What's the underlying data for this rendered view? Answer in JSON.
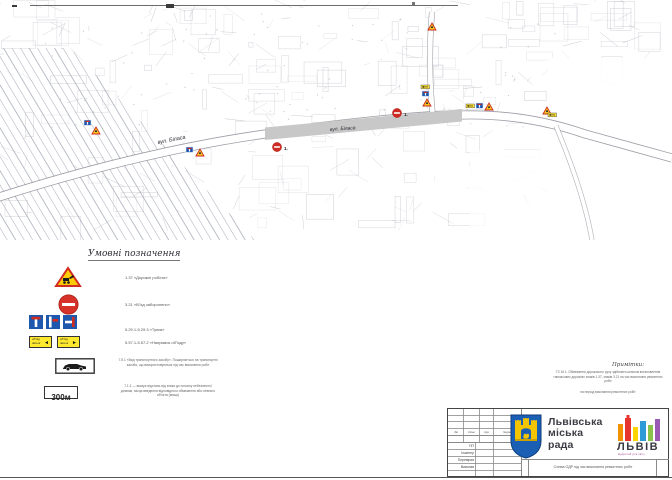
{
  "map": {
    "street_label_1": "вул. Біласа",
    "street_label_2": "вул. Біласа",
    "no_entry_label_1": "1.",
    "no_entry_label_2": "1."
  },
  "legend": {
    "title": "Умовні позначення",
    "rows": [
      {
        "code_text": "1.37 «Дорожні роботи»"
      },
      {
        "code_text": "3.21 «В'їзд заборонено»"
      },
      {
        "code_text": "5.29.1-5.29.3 «Тупик»"
      },
      {
        "code_text": "5.57.1-5.57.2 «Напрямок об'їзду»"
      },
      {
        "code_text": "7.5.1 «Вид транспортного засобу». Поширюється на транспортні засоби, що використовуються під час виконання робіт"
      },
      {
        "code_text": "7.1.1 — вказує відстань від знака до початку небезпечної ділянки, місця введення відповідного обмеження або певного об'єкта (місця)"
      }
    ],
    "detour_ua": "об'їзд",
    "detour_en": "detour",
    "distance_plate_label": "300м"
  },
  "notes": {
    "title": "Примітки:",
    "body": "ТЗ 16.1. Обмеження дорожнього руху здійснити шляхом встановлення тимчасових дорожніх знаків 1.37, знаків 3.21 на час виконання ремонтних робіт",
    "footer": "на період виконання ремонтних робіт"
  },
  "titleblock": {
    "org_name": "Львівська міська рада",
    "logo_text": "ЛЬВІВ",
    "logo_tagline": "відкритий для світу",
    "doc_title": "Схема ОДР під час виконання ремонтних робіт",
    "table_headers": [
      "Зм",
      "Кільк",
      "Арк",
      "№док"
    ],
    "table_roles": [
      "ГІП",
      "Інженер",
      "Перевірив",
      "Виконав"
    ]
  }
}
